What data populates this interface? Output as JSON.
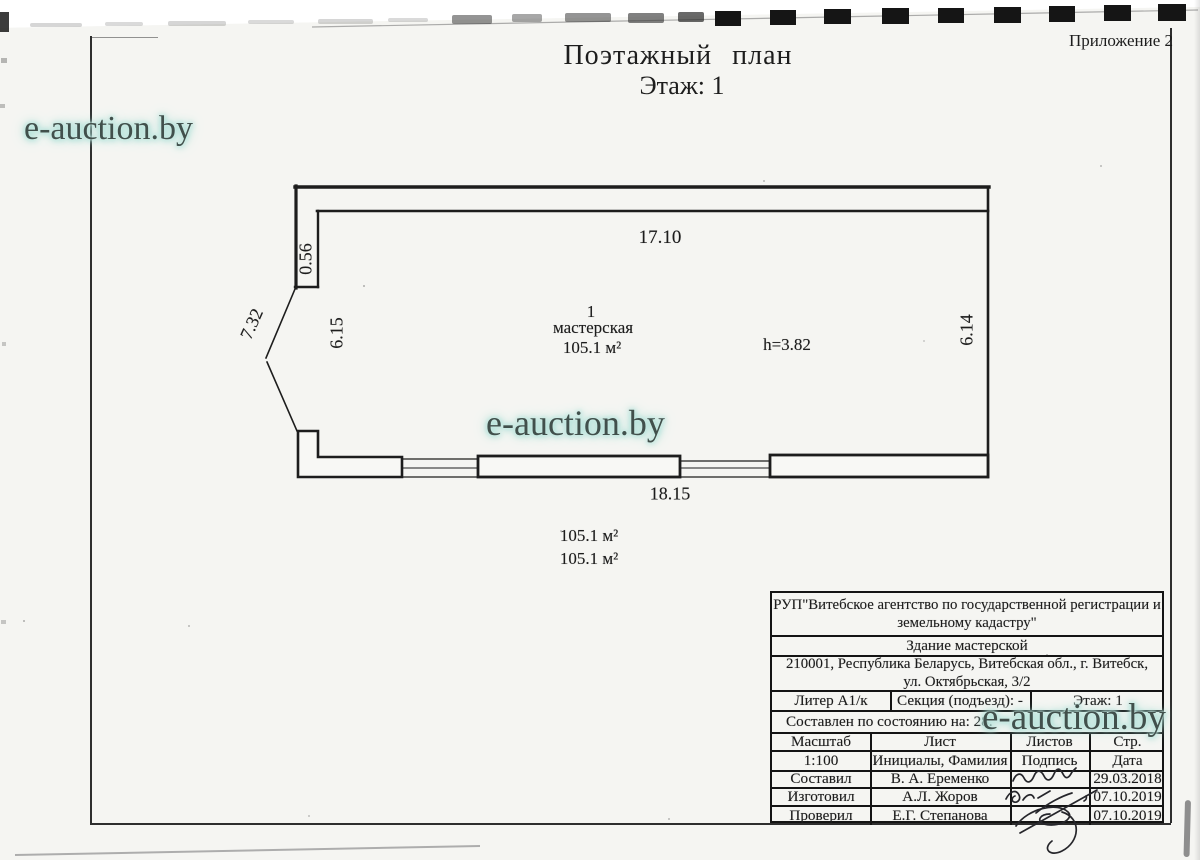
{
  "header": {
    "annex": "Приложение 2",
    "title": "Поэтажный план",
    "floor_line": "Этаж: 1"
  },
  "watermark": {
    "text": "e-auction.by"
  },
  "plan": {
    "room_number": "1",
    "room_name": "мастерская",
    "room_area": "105.1 м²",
    "height_note": "h=3.82",
    "dim_top": "17.10",
    "dim_bottom": "18.15",
    "dim_niche": "0.56",
    "dim_diag_left": "7.32",
    "dim_side_left": "6.15",
    "dim_side_right": "6.14",
    "area_notes": [
      "105.1 м²",
      "105.1 м²"
    ]
  },
  "info_table": {
    "org_line1": "РУП\"Витебское агентство по государственной регистрации и",
    "org_line2": "земельному кадастру\"",
    "building": "Здание мастерской",
    "address_line1": "210001, Республика Беларусь, Витебская обл., г. Витебск,",
    "address_line2": "ул. Октябрьская, 3/2",
    "liter": "Литер А1/к",
    "section": "Секция (подъезд): -",
    "floor": "Этаж: 1",
    "as_of": "Составлен по состоянию на: 28.",
    "col_headers": [
      "Масштаб",
      "Лист",
      "Листов",
      "Стр."
    ],
    "meta_row": [
      "1:100",
      "Инициалы, Фамилия",
      "Подпись",
      "Дата"
    ],
    "rows": [
      {
        "role": "Составил",
        "name": "В. А. Еременко",
        "date": "29.03.2018"
      },
      {
        "role": "Изготовил",
        "name": "А.Л. Жоров",
        "date": "07.10.2019"
      },
      {
        "role": "Проверил",
        "name": "Е.Г. Степанова",
        "date": "07.10.2019"
      }
    ]
  }
}
